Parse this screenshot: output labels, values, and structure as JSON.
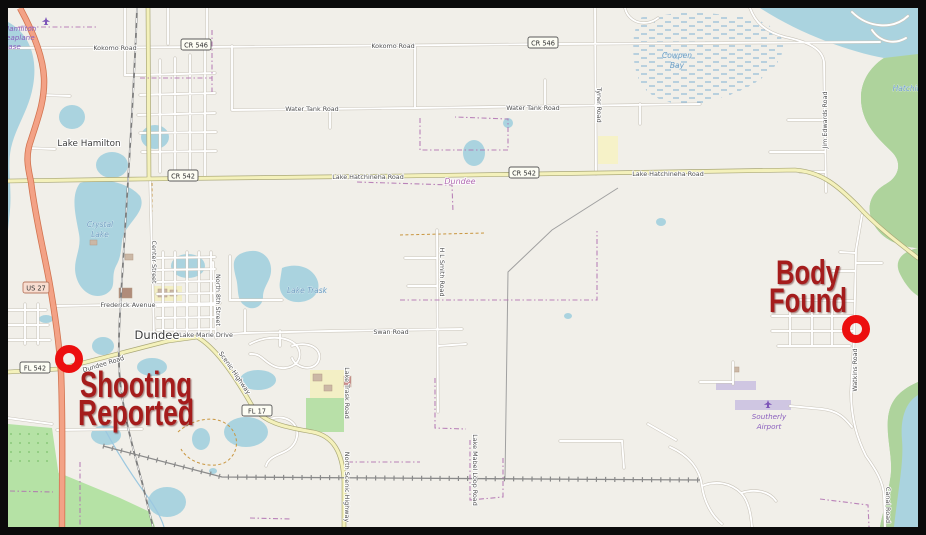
{
  "frame": {
    "border_color": "#0b0b0b"
  },
  "map": {
    "colors": {
      "land": "#f1efe9",
      "water": "#aad3df",
      "wood": "#aed39c",
      "orchard": "#b5e2a5",
      "park": "#b8e0a8",
      "trunk_road": "#f3a286",
      "secondary_road": "#f4f1bb",
      "minor_road": "#ffffff",
      "railway": "#7d7d7d",
      "boundary": "#b070b0",
      "runway": "#cfc6e2"
    },
    "road_labels": [
      {
        "t": "Kokomo Road",
        "x": 115,
        "y": 50
      },
      {
        "t": "Kokomo Road",
        "x": 393,
        "y": 48
      },
      {
        "t": "Water Tank Road",
        "x": 312,
        "y": 111
      },
      {
        "t": "Water Tank Road",
        "x": 533,
        "y": 110
      },
      {
        "t": "Lake Hatchineha Road",
        "x": 368,
        "y": 179
      },
      {
        "t": "Lake Hatchineha Road",
        "x": 668,
        "y": 176
      },
      {
        "t": "Frederick Avenue",
        "x": 128,
        "y": 307
      },
      {
        "t": "Lake Marie Drive",
        "x": 206,
        "y": 337
      },
      {
        "t": "Swan Road",
        "x": 391,
        "y": 334
      },
      {
        "t": "Dundee Road",
        "x": 104,
        "y": 366,
        "r": -17
      },
      {
        "t": "Scenic Highway",
        "x": 233,
        "y": 374,
        "r": 55
      },
      {
        "t": "North Scenic Highway",
        "x": 345,
        "y": 487,
        "r": 90,
        "anchor": "start"
      },
      {
        "t": "Center Street",
        "x": 152,
        "y": 262,
        "r": 90
      },
      {
        "t": "North 8th Street",
        "x": 216,
        "y": 300,
        "r": 90
      },
      {
        "t": "Tyner Road",
        "x": 597,
        "y": 105,
        "r": 90
      },
      {
        "t": "Jim Edwards Road",
        "x": 827,
        "y": 120,
        "r": -90
      },
      {
        "t": "H L Smith Road",
        "x": 440,
        "y": 272,
        "r": 90
      },
      {
        "t": "Lake Trask Road",
        "x": 345,
        "y": 393,
        "r": 90
      },
      {
        "t": "Lake Mabel Loop Road",
        "x": 473,
        "y": 470,
        "r": 90
      },
      {
        "t": "Watkins Road",
        "x": 857,
        "y": 370,
        "r": -90
      },
      {
        "t": "Canal Road",
        "x": 886,
        "y": 505,
        "r": 90
      }
    ],
    "shields": [
      {
        "t": "CR 546",
        "x": 196,
        "y": 45,
        "cls": "cr"
      },
      {
        "t": "CR 546",
        "x": 543,
        "y": 43,
        "cls": "cr"
      },
      {
        "t": "CR 542",
        "x": 183,
        "y": 176,
        "cls": "cr"
      },
      {
        "t": "CR 542",
        "x": 524,
        "y": 173,
        "cls": "cr"
      },
      {
        "t": "US 27",
        "x": 36,
        "y": 288,
        "cls": "us"
      },
      {
        "t": "FL 542",
        "x": 35,
        "y": 368,
        "cls": "fl"
      },
      {
        "t": "FL 17",
        "x": 257,
        "y": 411,
        "cls": "fl"
      }
    ],
    "places": [
      {
        "t": "Lake Hamilton",
        "x": 89,
        "y": 146,
        "cls": "town"
      },
      {
        "t": "Dundee",
        "x": 157,
        "y": 339,
        "cls": "town-lg"
      },
      {
        "t": "Dundee",
        "x": 460,
        "y": 184,
        "cls": "bound"
      },
      {
        "t": "Crystal",
        "x": 100,
        "y": 227,
        "cls": "water-lbl"
      },
      {
        "t": "Lake",
        "x": 100,
        "y": 237,
        "cls": "water-lbl"
      },
      {
        "t": "Lake Trask",
        "x": 307,
        "y": 293,
        "cls": "water-lbl"
      },
      {
        "t": "Cowpen",
        "x": 677,
        "y": 58,
        "cls": "water-lbl"
      },
      {
        "t": "Bay",
        "x": 677,
        "y": 68,
        "cls": "water-lbl"
      },
      {
        "t": "Hatchineha",
        "x": 914,
        "y": 91,
        "cls": "water-lbl",
        "anchor": "start"
      },
      {
        "t": "Hamilton",
        "x": 20,
        "y": 31,
        "cls": "air"
      },
      {
        "t": "Seaplane",
        "x": 18,
        "y": 40,
        "cls": "air"
      },
      {
        "t": "Base",
        "x": 12,
        "y": 49,
        "cls": "air"
      },
      {
        "t": "Southerly",
        "x": 769,
        "y": 419,
        "cls": "air"
      },
      {
        "t": "Airport",
        "x": 769,
        "y": 429,
        "cls": "air"
      }
    ],
    "icons": [
      {
        "name": "seaplane-icon",
        "x": 46,
        "y": 21
      },
      {
        "name": "airport-plane-icon",
        "x": 768,
        "y": 404
      }
    ]
  },
  "annotations": {
    "circle_color": "#ec0f0f",
    "text_color": "#a51f1f",
    "items": [
      {
        "id": "shooting-reported",
        "lines": [
          "Shooting",
          "Reported"
        ],
        "circle": {
          "cx": 69,
          "cy": 359,
          "r": 10,
          "stroke_width": 8
        },
        "text": {
          "x": 136,
          "y": 397,
          "lh": 28,
          "size": 36,
          "len": [
            112,
            116
          ]
        }
      },
      {
        "id": "body-found",
        "lines": [
          "Body",
          "Found"
        ],
        "circle": {
          "cx": 856,
          "cy": 329,
          "r": 10,
          "stroke_width": 8
        },
        "text": {
          "x": 808,
          "y": 284,
          "lh": 28,
          "size": 34,
          "len": [
            64,
            78
          ]
        }
      }
    ]
  }
}
